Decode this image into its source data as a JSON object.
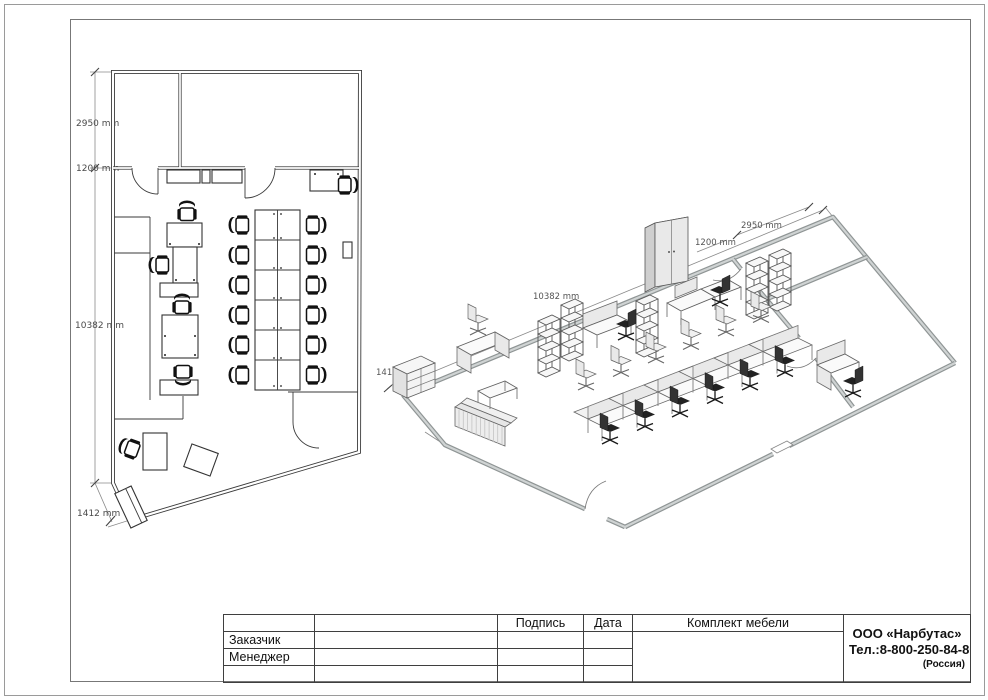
{
  "plan": {
    "dims": {
      "top_height": "2950 mm",
      "wall_offset": "1200 mm",
      "side_length": "10382 mm",
      "corner": "1412 mm"
    }
  },
  "iso": {
    "dims": {
      "side_length": "10382 mm",
      "top_width": "2950 mm",
      "wall_offset": "1200 mm",
      "corner": "1412 mm"
    }
  },
  "title_block": {
    "headers": {
      "signature": "Подпись",
      "date": "Дата",
      "set": "Комплект мебели"
    },
    "rows": {
      "customer": "Заказчик",
      "manager": "Менеджер"
    },
    "company": {
      "name": "ООО «Нарбутас»",
      "phone": "Тел.:8-800-250-84-80",
      "country": "(Россия)"
    }
  }
}
